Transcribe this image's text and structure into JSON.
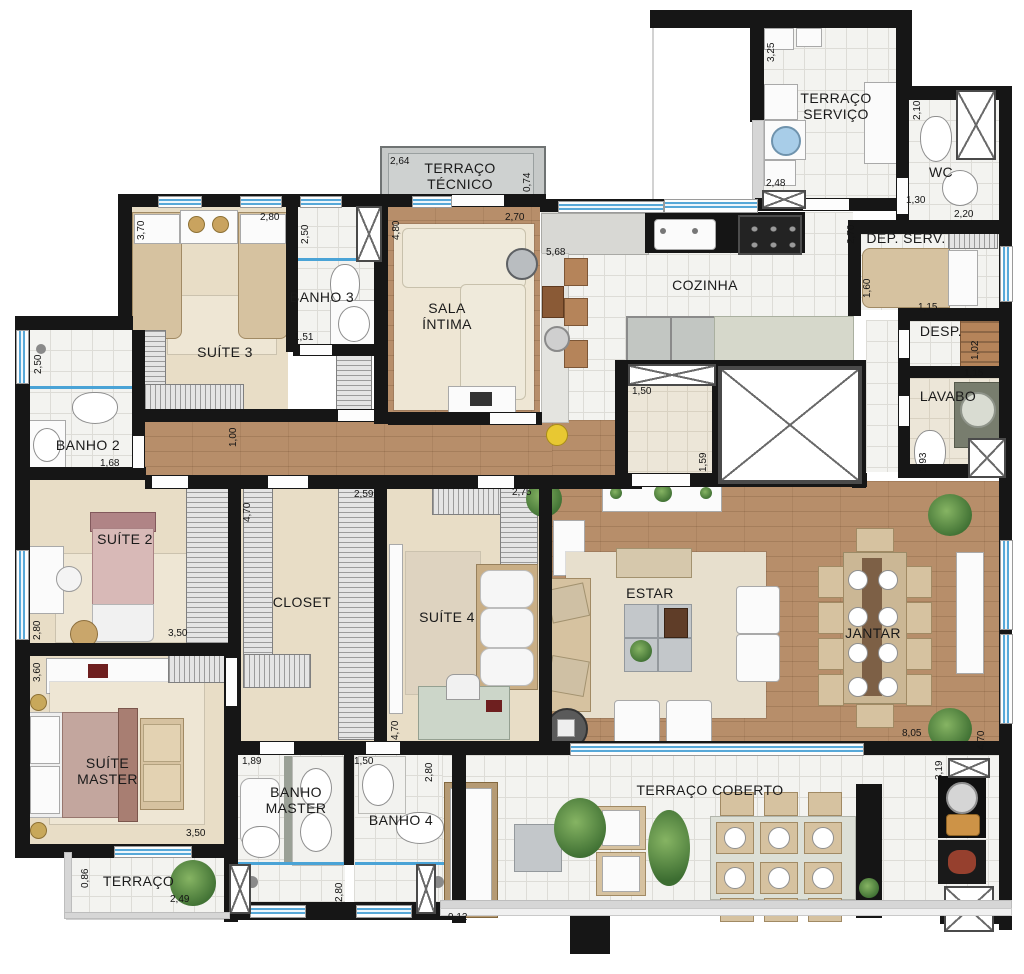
{
  "plan_type": "apartment-floor-plan",
  "colors": {
    "wall": "#161616",
    "wood_floor": "#b78e6a",
    "tile_floor": "#f3f3f0",
    "carpet_floor": "#e8ddc6",
    "window_glass": "#57a8d8",
    "terrace_slab": "#c6c9c8"
  },
  "rooms": {
    "terraco_tecnico": {
      "label": "TERRAÇO TÉCNICO"
    },
    "suite3": {
      "label": "SUÍTE 3"
    },
    "banho3": {
      "label": "BANHO 3"
    },
    "sala_intima": {
      "label": "SALA ÍNTIMA"
    },
    "cozinha": {
      "label": "COZINHA"
    },
    "terraco_servico": {
      "label": "TERRAÇO SERVIÇO"
    },
    "wc": {
      "label": "WC"
    },
    "dep_serv": {
      "label": "DEP. SERV."
    },
    "desp": {
      "label": "DESP."
    },
    "lavabo": {
      "label": "LAVABO"
    },
    "banho2": {
      "label": "BANHO 2"
    },
    "suite2": {
      "label": "SUÍTE 2"
    },
    "closet": {
      "label": "CLOSET"
    },
    "suite4": {
      "label": "SUÍTE 4"
    },
    "estar": {
      "label": "ESTAR"
    },
    "jantar": {
      "label": "JANTAR"
    },
    "suite_master": {
      "label": "SUÍTE MASTER"
    },
    "banho_master": {
      "label": "BANHO MASTER"
    },
    "banho4": {
      "label": "BANHO 4"
    },
    "terraco": {
      "label": "TERRAÇO"
    },
    "terraco_coberto": {
      "label": "TERRAÇO COBERTO"
    }
  },
  "dims": {
    "d01": {
      "t": "2,64"
    },
    "d02": {
      "t": "0,74"
    },
    "d03": {
      "t": "3,70"
    },
    "d04": {
      "t": "2,80"
    },
    "d05": {
      "t": "2,50"
    },
    "d06": {
      "t": "4,80"
    },
    "d07": {
      "t": "2,70"
    },
    "d08": {
      "t": "5,68"
    },
    "d09": {
      "t": "3,25"
    },
    "d10": {
      "t": "2,48"
    },
    "d11": {
      "t": "2,10"
    },
    "d12": {
      "t": "1,30"
    },
    "d13": {
      "t": "2,20"
    },
    "d14": {
      "t": "2,70"
    },
    "d15": {
      "t": "1,60"
    },
    "d16": {
      "t": "1,15"
    },
    "d17": {
      "t": "1,02"
    },
    "d18": {
      "t": "1,15"
    },
    "d19": {
      "t": "1,93"
    },
    "d20": {
      "t": "2,50"
    },
    "d21": {
      "t": "1,68"
    },
    "d22": {
      "t": "1,51"
    },
    "d23": {
      "t": "1,00"
    },
    "d24": {
      "t": "1,50"
    },
    "d25": {
      "t": "1,59"
    },
    "d26": {
      "t": "2,80"
    },
    "d27": {
      "t": "3,50"
    },
    "d28": {
      "t": "4,70"
    },
    "d29": {
      "t": "2,59"
    },
    "d30": {
      "t": "2,75"
    },
    "d31": {
      "t": "4,70"
    },
    "d32": {
      "t": "3,60"
    },
    "d33": {
      "t": "3,50"
    },
    "d34": {
      "t": "0,86"
    },
    "d35": {
      "t": "2,49"
    },
    "d36": {
      "t": "1,89"
    },
    "d37": {
      "t": "2,80"
    },
    "d38": {
      "t": "1,50"
    },
    "d39": {
      "t": "2,80"
    },
    "d40": {
      "t": "8,05"
    },
    "d41": {
      "t": "4,70"
    },
    "d42": {
      "t": "9,12"
    },
    "d43": {
      "t": "3,19"
    }
  }
}
